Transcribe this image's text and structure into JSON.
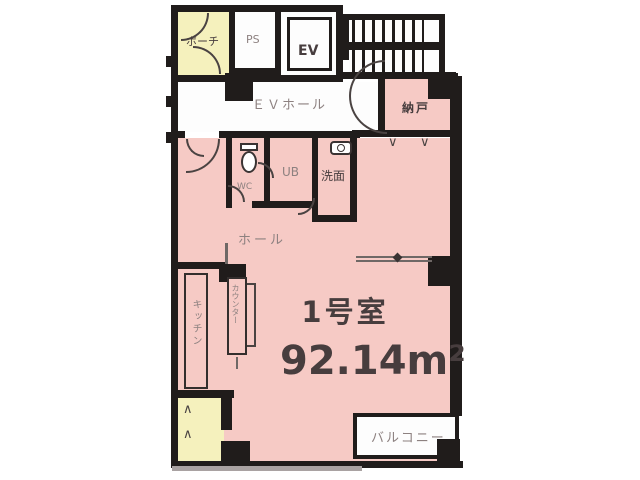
{
  "unit": {
    "name": "1号室",
    "area": "92.14m²"
  },
  "rooms": {
    "porch": {
      "label": "ポーチ"
    },
    "pipe_space": {
      "label": "PS"
    },
    "elevator": {
      "label": "EV"
    },
    "ev_hall": {
      "label": "ＥＶホール"
    },
    "storage": {
      "label": "納戸"
    },
    "toilet": {
      "label": "WC"
    },
    "unit_bath": {
      "label": "UB"
    },
    "washroom": {
      "label": "洗面"
    },
    "hall": {
      "label": "ホール"
    },
    "kitchen": {
      "label": "キッチン"
    },
    "counter": {
      "label": "カウンター"
    },
    "balcony": {
      "label": "バルコニー"
    }
  },
  "symbols": {
    "folding_door_mark": "∨",
    "hatch_mark": "∧"
  },
  "colors": {
    "wall": "#201c1b",
    "pink": "#f6cac5",
    "yellow": "#f5f1bd",
    "gray_label": "#8d8180",
    "dark_label": "#473d3e"
  }
}
